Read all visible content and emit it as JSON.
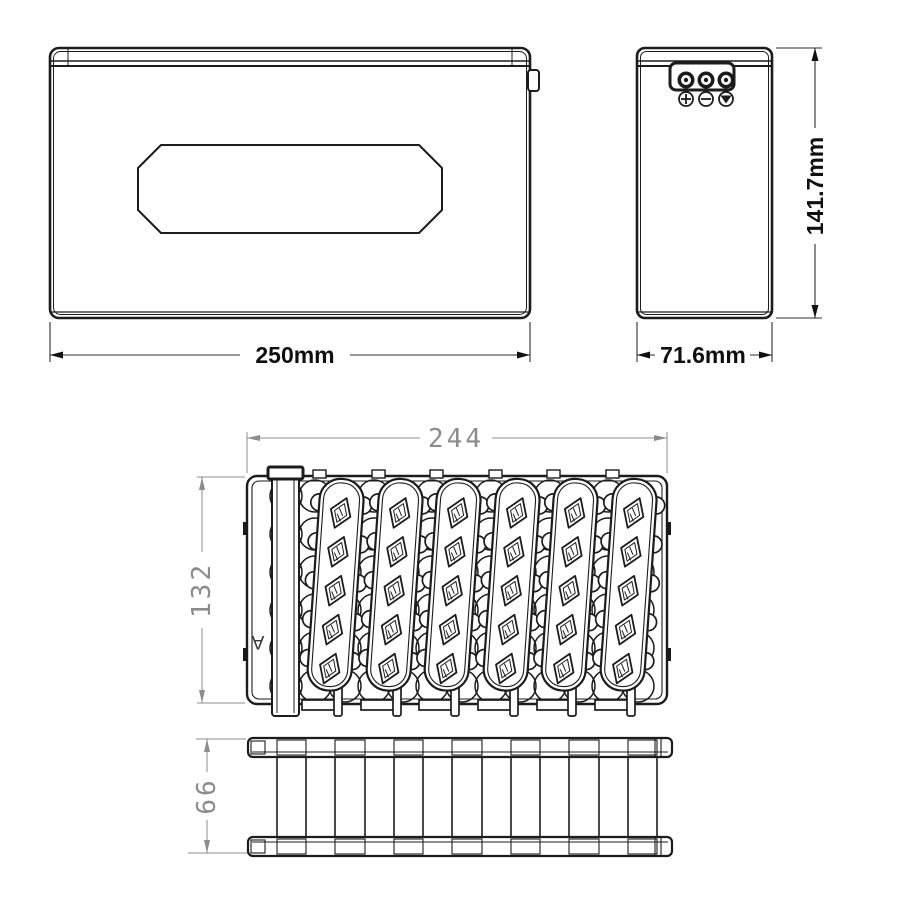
{
  "drawing": {
    "type": "battery-pack-technical-drawing",
    "front_view": {
      "width_label": "250mm"
    },
    "side_view": {
      "height_label": "141.7mm",
      "depth_label": "71.6mm"
    },
    "pack_top_view": {
      "width_label": "244",
      "height_label": "132",
      "section_marker": "A"
    },
    "pack_front_view": {
      "height_label": "66"
    },
    "colors": {
      "line": "#1c1c1c",
      "dim_text": "#0f0f0f",
      "cad_dim": "#8c8c8c",
      "background": "#ffffff"
    }
  }
}
